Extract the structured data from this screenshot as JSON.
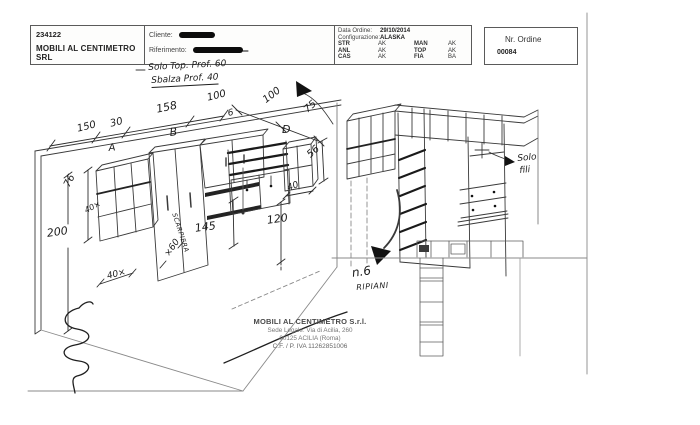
{
  "header": {
    "order_code": "234122",
    "company_name": "MOBILI AL CENTIMETRO SRL",
    "cliente_label": "Cliente:",
    "riferimento_label": "Riferimento:",
    "data_ordine_label": "Data Ordine:",
    "data_ordine_value": "29/10/2014",
    "configurazione_label": "Configurazione:",
    "configurazione_value": "ALASKA",
    "finishes": [
      {
        "k1": "STR",
        "v1": "AK",
        "k2": "MAN",
        "v2": "AK"
      },
      {
        "k1": "ANL",
        "v1": "AK",
        "k2": "TOP",
        "v2": "AK"
      },
      {
        "k1": "CAS",
        "v1": "AK",
        "k2": "FIA",
        "v2": "BA"
      }
    ],
    "nr_ordine_label": "Nr. Ordine",
    "nr_ordine_value": "00084"
  },
  "notes": {
    "top_line1": "Solo Top. Prof. 60",
    "top_line2": "Sbalza Prof. 40",
    "solo_fili_line1": "Solo",
    "solo_fili_line2": "fili",
    "ripiani_line1": "n.6",
    "ripiani_line2": "RIPIANI"
  },
  "dims_left": {
    "d150": "150",
    "d30": "30",
    "d158": "158",
    "d100a": "100",
    "d6": "6",
    "d100b": "100",
    "d75": "75",
    "unit_a": "A",
    "unit_b": "B",
    "unit_d": "D",
    "d76": "76",
    "d40top": "40×",
    "d200": "200",
    "scarpiera": "SCARPIERA",
    "d145": "145",
    "d60": "×60",
    "d40base": "40×",
    "d56": "56",
    "d40cube": "40",
    "d120": "120"
  },
  "footer": {
    "company": "MOBILI AL CENTIMETRO S.r.l.",
    "address_line1": "Sede Legale: Via di Acilia, 260",
    "address_line2": "00125 ACILIA (Roma)",
    "vat_line": "C.F. / P. IVA 11262851006"
  },
  "colors": {
    "ink": "#1c1c1c",
    "print": "#333333",
    "faint_line": "#999999"
  }
}
